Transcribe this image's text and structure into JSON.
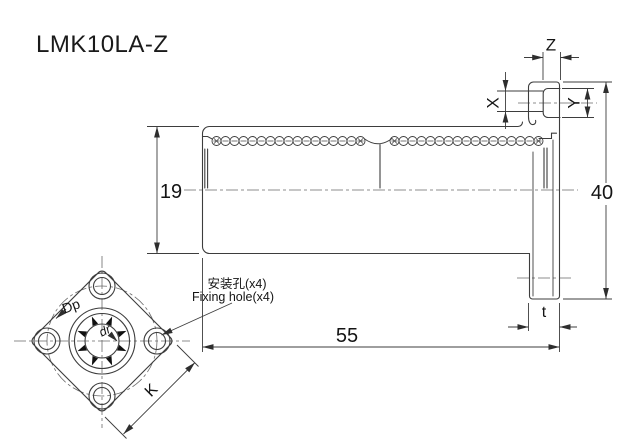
{
  "title": "LMK10LA-Z",
  "notes": {
    "fixing_hole_cn": "安装孔(x4)",
    "fixing_hole_en": "Fixing hole(x4)"
  },
  "dimensions": {
    "outer_diameter": "19",
    "flange_diameter": "40",
    "body_length": "55",
    "flange_thickness": "t",
    "nipple_x": "X",
    "nipple_y": "Y",
    "nipple_z": "Z",
    "flange_width_k": "K",
    "pitch_circle": "Dp",
    "bore_diameter": "dr"
  },
  "colors": {
    "line": "#3d3d3d",
    "centerline": "#6a6a6a",
    "text": "#141414",
    "background": "#ffffff"
  }
}
